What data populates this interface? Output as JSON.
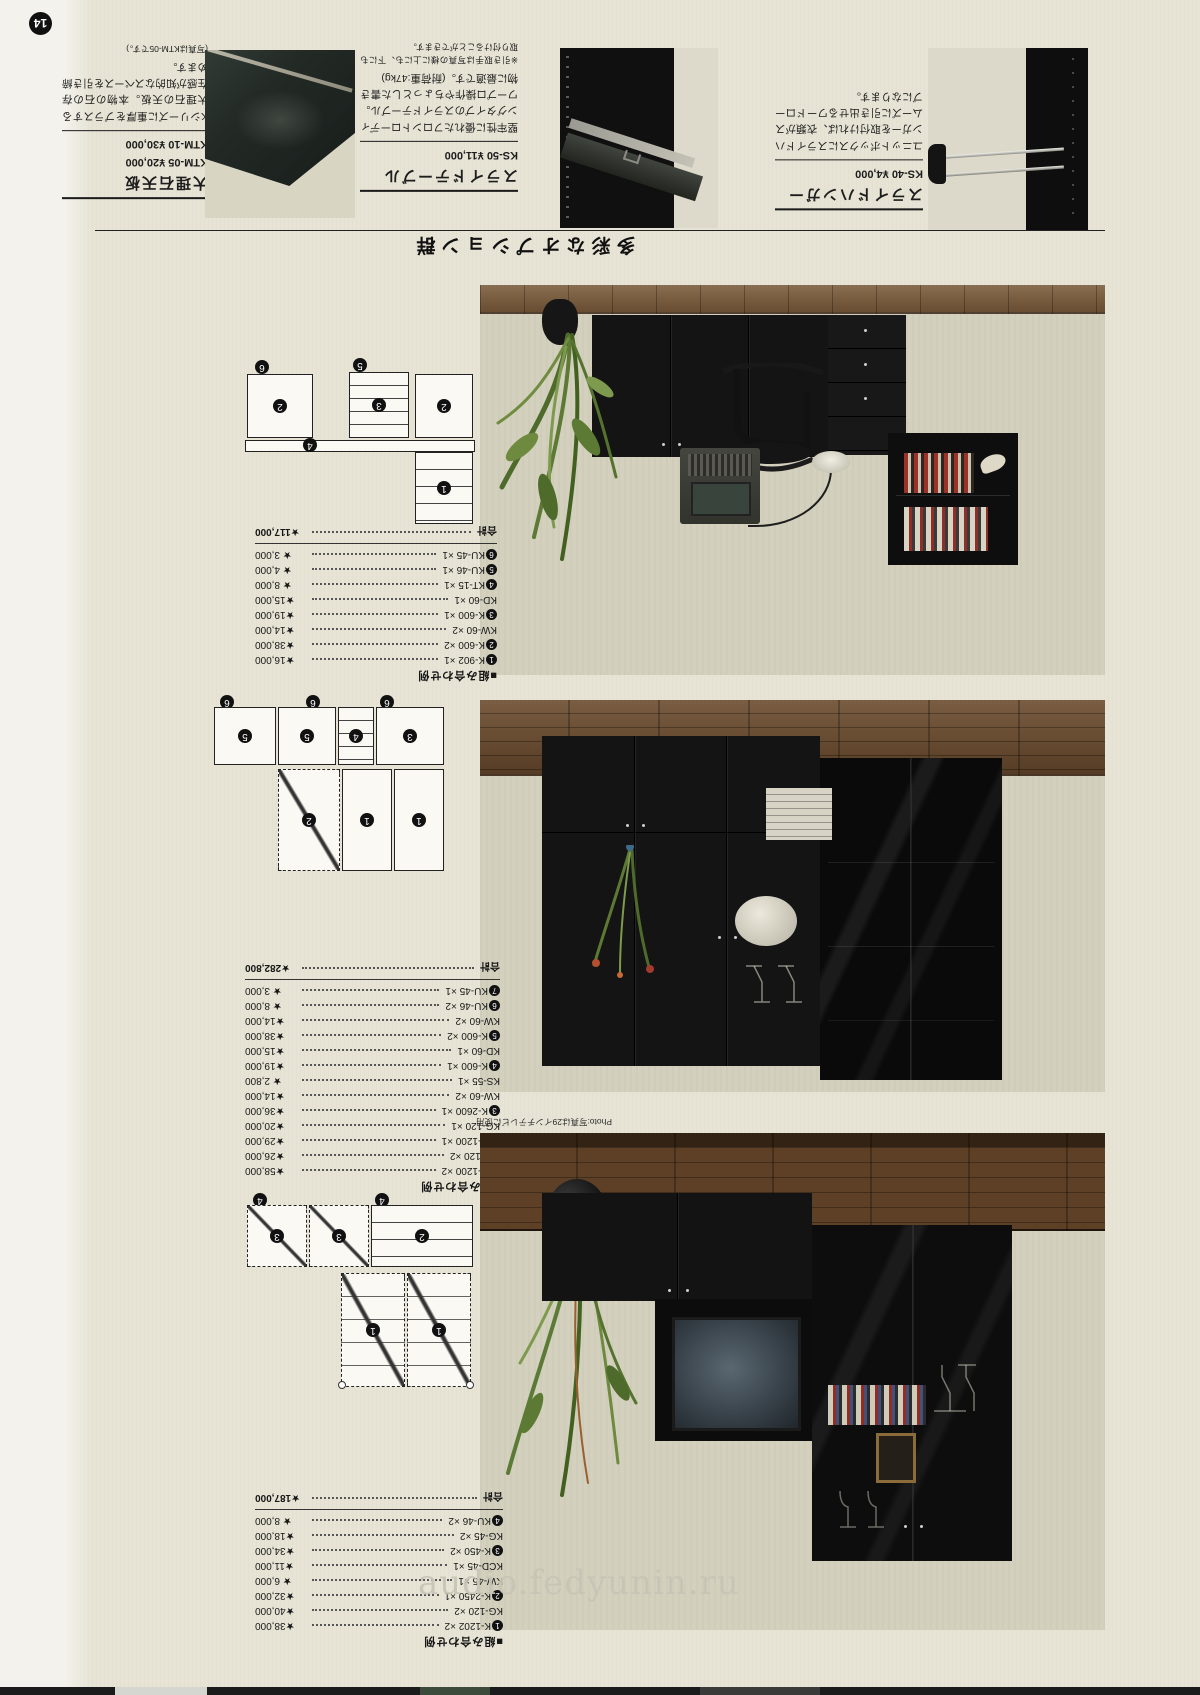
{
  "page_number": "14",
  "watermark_text": "audio.fedyunin.ru",
  "options": {
    "section_title": "多彩なオプション群",
    "products": [
      {
        "name": "スライドハンガー",
        "prices": [
          "KS-40 ¥4,000"
        ],
        "description": "ユニットボックスにスライドハンガーを取付ければ、衣類がスムーズに引き出せるワードローブになります。",
        "note": ""
      },
      {
        "name": "スライドテーブル",
        "prices": [
          "KS-50 ¥11,000"
        ],
        "description": "堅牢性に優れたフロントローディングタイプのスライドテーブル。ワープロ操作やちょっとした書き物に最適です。(耐荷重:47kg)",
        "note": "※引き取手は写真の様に上にも、下にも取り付けることができます。"
      },
      {
        "name": "大理石天板",
        "prices": [
          "KTM-05 ¥20,000",
          "KTM-10 ¥30,000"
        ],
        "description": "Kシリーズに重厚をプラスする大理石の天板。本物の石の存在感が知的なスペースを引き締めます。",
        "note": "(写真はKTM-05です。)"
      }
    ]
  },
  "photo_caption": "Photo:写真は29インチテレビに使用",
  "arrangements": [
    {
      "heading": "■組み合わせ例",
      "rows": [
        {
          "num": "1",
          "code": "K-902 ×1",
          "price": "★16,000"
        },
        {
          "num": "2",
          "code": "K-600 ×2",
          "price": "★38,000"
        },
        {
          "num": "",
          "code": "KW-60 ×2",
          "price": "★14,000"
        },
        {
          "num": "3",
          "code": "K-600 ×1",
          "price": "★19,000"
        },
        {
          "num": "",
          "code": "KD-60 ×1",
          "price": "★15,000"
        },
        {
          "num": "4",
          "code": "KT-15 ×1",
          "price": "★ 8,000"
        },
        {
          "num": "5",
          "code": "KU-46 ×1",
          "price": "★ 4,000"
        },
        {
          "num": "6",
          "code": "KU-45 ×1",
          "price": "★ 3,000"
        }
      ],
      "total_label": "合計",
      "total": "★117,000"
    },
    {
      "heading": "■組み合わせ例",
      "rows": [
        {
          "num": "1",
          "code": "K-1200 ×2",
          "price": "★58,000"
        },
        {
          "num": "",
          "code": "KW-120 ×2",
          "price": "★26,000"
        },
        {
          "num": "2",
          "code": "K-1200 ×1",
          "price": "★29,000"
        },
        {
          "num": "",
          "code": "KG-120 ×1",
          "price": "★20,000"
        },
        {
          "num": "3",
          "code": "K-2600 ×1",
          "price": "★36,000"
        },
        {
          "num": "",
          "code": "KW-60 ×2",
          "price": "★14,000"
        },
        {
          "num": "",
          "code": "KS-55 ×1",
          "price": "★ 2,800"
        },
        {
          "num": "4",
          "code": "K-600 ×1",
          "price": "★19,000"
        },
        {
          "num": "",
          "code": "KD-60 ×1",
          "price": "★15,000"
        },
        {
          "num": "5",
          "code": "K-600 ×2",
          "price": "★38,000"
        },
        {
          "num": "",
          "code": "KW-60 ×2",
          "price": "★14,000"
        },
        {
          "num": "6",
          "code": "KU-46 ×2",
          "price": "★ 8,000"
        },
        {
          "num": "7",
          "code": "KU-45 ×1",
          "price": "★ 3,000"
        }
      ],
      "total_label": "合計",
      "total": "★282,800"
    },
    {
      "heading": "■組み合わせ例",
      "rows": [
        {
          "num": "1",
          "code": "K-1202 ×2",
          "price": "★38,000"
        },
        {
          "num": "",
          "code": "KG-120 ×2",
          "price": "★40,000"
        },
        {
          "num": "2",
          "code": "K-2450 ×1",
          "price": "★32,000"
        },
        {
          "num": "",
          "code": "KW-45 ×1",
          "price": "★ 6,000"
        },
        {
          "num": "",
          "code": "KCD-45 ×1",
          "price": "★11,000"
        },
        {
          "num": "3",
          "code": "K-450 ×2",
          "price": "★34,000"
        },
        {
          "num": "",
          "code": "KG-45 ×2",
          "price": "★18,000"
        },
        {
          "num": "4",
          "code": "KU-46 ×2",
          "price": "★ 8,000"
        }
      ],
      "total_label": "合計",
      "total": "★187,000"
    }
  ],
  "diagram_labels": {
    "a": [
      "6",
      "2",
      "5",
      "3",
      "2",
      "4",
      "1"
    ],
    "b": [
      "6",
      "6",
      "6",
      "5",
      "5",
      "4",
      "3",
      "2",
      "1",
      "1"
    ],
    "c": [
      "4",
      "4",
      "3",
      "3",
      "2",
      "1",
      "1"
    ]
  },
  "colors": {
    "paper": "#e7e4d5",
    "photo_wall": "#d2cfbc",
    "wood": "#6b4b2d",
    "furniture_black": "#131313",
    "accent_red": "#9c3128"
  }
}
